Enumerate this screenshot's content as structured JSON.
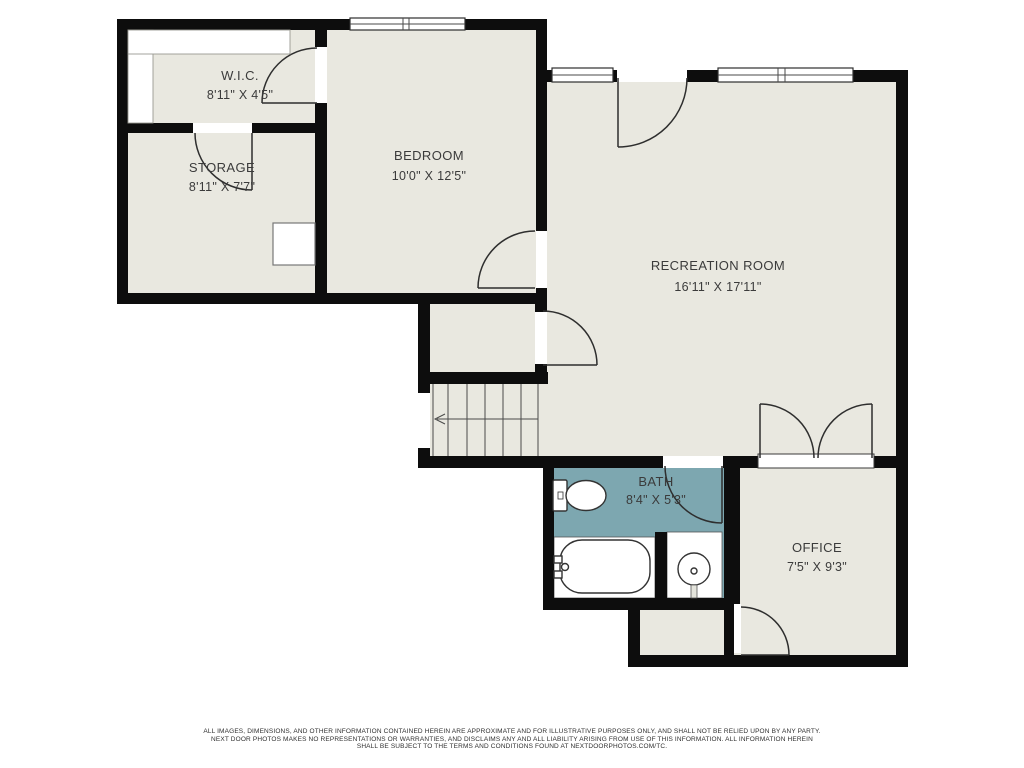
{
  "plan": {
    "title": "Basement floor plan",
    "rooms": {
      "wic": {
        "name": "W.I.C.",
        "dims": "8'11\" X 4'5\""
      },
      "storage": {
        "name": "STORAGE",
        "dims": "8'11\" X 7'7\""
      },
      "bedroom": {
        "name": "BEDROOM",
        "dims": "10'0\" X 12'5\""
      },
      "recreation": {
        "name": "RECREATION ROOM",
        "dims": "16'11\" X 17'11\""
      },
      "bath": {
        "name": "BATH",
        "dims": "8'4\" X 5'3\""
      },
      "office": {
        "name": "OFFICE",
        "dims": "7'5\" X 9'3\""
      }
    },
    "colors": {
      "wall": "#0d0d0d",
      "floor": "#e9e8e0",
      "bath_floor": "#7da7b0",
      "line": "#2e2e2e",
      "label_text": "#3b3b3b"
    }
  },
  "footer": {
    "line1": "ALL IMAGES, DIMENSIONS, AND OTHER INFORMATION CONTAINED HEREIN ARE APPROXIMATE AND FOR ILLUSTRATIVE PURPOSES ONLY, AND SHALL NOT BE RELIED UPON BY ANY PARTY.",
    "line2": "NEXT DOOR PHOTOS MAKES NO REPRESENTATIONS OR WARRANTIES, AND DISCLAIMS ANY AND ALL LIABILITY ARISING FROM USE OF THIS INFORMATION. ALL INFORMATION HEREIN",
    "line3": "SHALL BE SUBJECT TO THE TERMS AND CONDITIONS FOUND AT NEXTDOORPHOTOS.COM/TC."
  }
}
